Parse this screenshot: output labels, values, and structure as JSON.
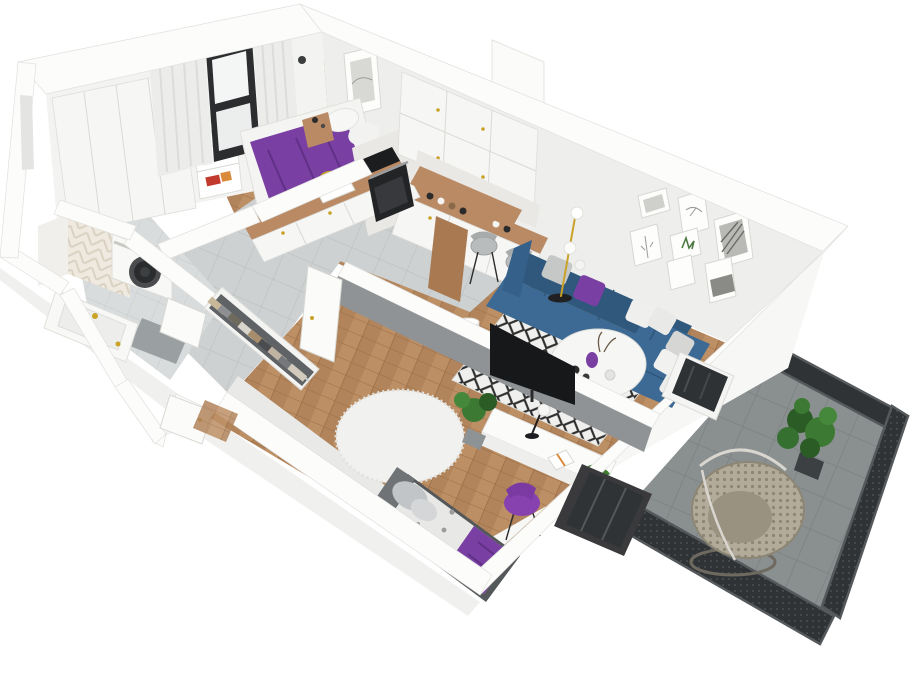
{
  "scene": {
    "type": "isometric-3d-apartment-floor-plan-render",
    "rooms": [
      {
        "name": "bedroom",
        "items": [
          "double-bed-purple-cover",
          "white-pillows",
          "wood-nightstand",
          "built-in-wardrobe",
          "book-niche",
          "window-with-curtains",
          "wall-art-frame"
        ]
      },
      {
        "name": "kitchen",
        "items": [
          "upper-cabinets",
          "base-cabinets",
          "wood-countertop",
          "sink-gold-faucet",
          "cooktop",
          "oven",
          "wood-bar-peninsula",
          "two-bar-chairs",
          "jars"
        ]
      },
      {
        "name": "living-room",
        "items": [
          "blue-corner-sofa",
          "purple-pillow",
          "white-pillows",
          "round-coffee-table",
          "diamond-pattern-rug",
          "floor-lamp-three-globes",
          "gallery-wall-seven-frames",
          "tv-on-partition",
          "balcony-door"
        ]
      },
      {
        "name": "kids-room",
        "items": [
          "single-bed-purple-throw",
          "gray-headboard",
          "round-fluffy-rug",
          "white-desk",
          "desk-lamp",
          "open-book",
          "toy-dinosaur",
          "purple-chair",
          "potted-plants",
          "window-to-balcony"
        ]
      },
      {
        "name": "hallway",
        "items": [
          "open-closet-hanging-clothes",
          "white-doors",
          "entry-door",
          "wood-mat"
        ]
      },
      {
        "name": "bathroom",
        "items": [
          "washing-machine",
          "bathtub-counter",
          "chevron-tile-wall",
          "shower-tray",
          "gold-fixtures"
        ]
      },
      {
        "name": "balcony",
        "items": [
          "dark-tile-floor",
          "mesh-railing",
          "rattan-egg-chair",
          "large-plant",
          "glass-door"
        ]
      }
    ]
  },
  "palette": {
    "wall_top": "#fcfcfb",
    "wall_face": "#f3f3f1",
    "wood_floor": "#b2845c",
    "tile_gray": "#cdd1d1",
    "counter_wood": "#b98a64",
    "bar_wood": "#a97a52",
    "marble": "#eae8e5",
    "sofa_blue": "#3c6a94",
    "sofa_blue_dark": "#30587c",
    "accent_purple": "#7a3fa3",
    "purple_dark": "#603086",
    "chair_purple": "#8742b0",
    "rug_white": "#efefed",
    "rug_black": "#2e2e2e",
    "partition_gray": "#8f9395",
    "tv_black": "#17181a",
    "balcony_floor": "#8a8f90",
    "railing_mesh": "#2f3335",
    "railing_frame": "#55595c",
    "plant_green": "#3c7a33",
    "plant_green_dark": "#2c5c26",
    "gold": "#c9a227",
    "machine_door": "#2a2c2e",
    "bed_frame_gray": "#6f7375",
    "pillow_gray": "#c6c8c8",
    "egg_chair_rattan": "#b3ab9a",
    "desk_white": "#fbfbf9",
    "spot_blanket": "#e8e8e6"
  }
}
